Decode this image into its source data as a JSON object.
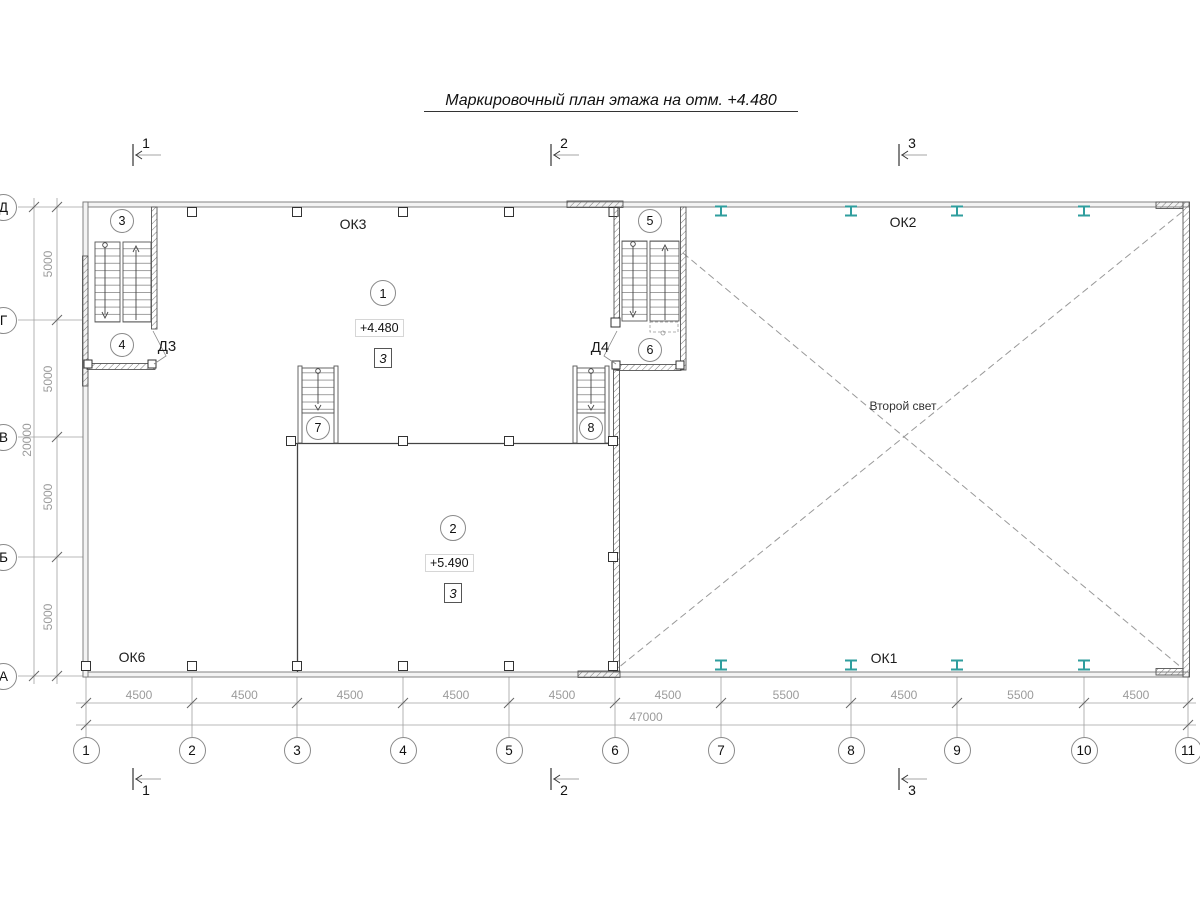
{
  "title": "Маркировочный план этажа на отм. +4.480",
  "colors": {
    "steel": "#2f9e9e",
    "dims": "#9b9b9b",
    "walls": "#555555",
    "dash": "#999999"
  },
  "section_marks": {
    "top": [
      "1",
      "2",
      "3"
    ],
    "bottom": [
      "1",
      "2",
      "3"
    ]
  },
  "axes": {
    "bottom": {
      "labels": [
        "1",
        "2",
        "3",
        "4",
        "5",
        "6",
        "7",
        "8",
        "9",
        "10",
        "11"
      ]
    },
    "left": {
      "labels": [
        "Д",
        "Г",
        "В",
        "Б",
        "А"
      ]
    }
  },
  "dimensions": {
    "bottom": {
      "segments": [
        "4500",
        "4500",
        "4500",
        "4500",
        "4500",
        "4500",
        "5500",
        "4500",
        "5500",
        "4500"
      ],
      "total": "47000"
    },
    "left": {
      "segments": [
        "5000",
        "5000",
        "5000",
        "5000"
      ],
      "total": "20000"
    }
  },
  "rooms": [
    {
      "bubble": "1",
      "elevation": "+4.480",
      "doc_ref": "3"
    },
    {
      "bubble": "2",
      "elevation": "+5.490",
      "doc_ref": "3"
    }
  ],
  "stairs": {
    "bubbles": [
      "3",
      "4",
      "5",
      "6",
      "7",
      "8"
    ]
  },
  "doors": {
    "labels": [
      "Д3",
      "Д4"
    ]
  },
  "windows": {
    "labels": [
      "ОК3",
      "ОК2",
      "ОК6",
      "ОК1"
    ]
  },
  "annotations": {
    "second_light": "Второй свет"
  }
}
